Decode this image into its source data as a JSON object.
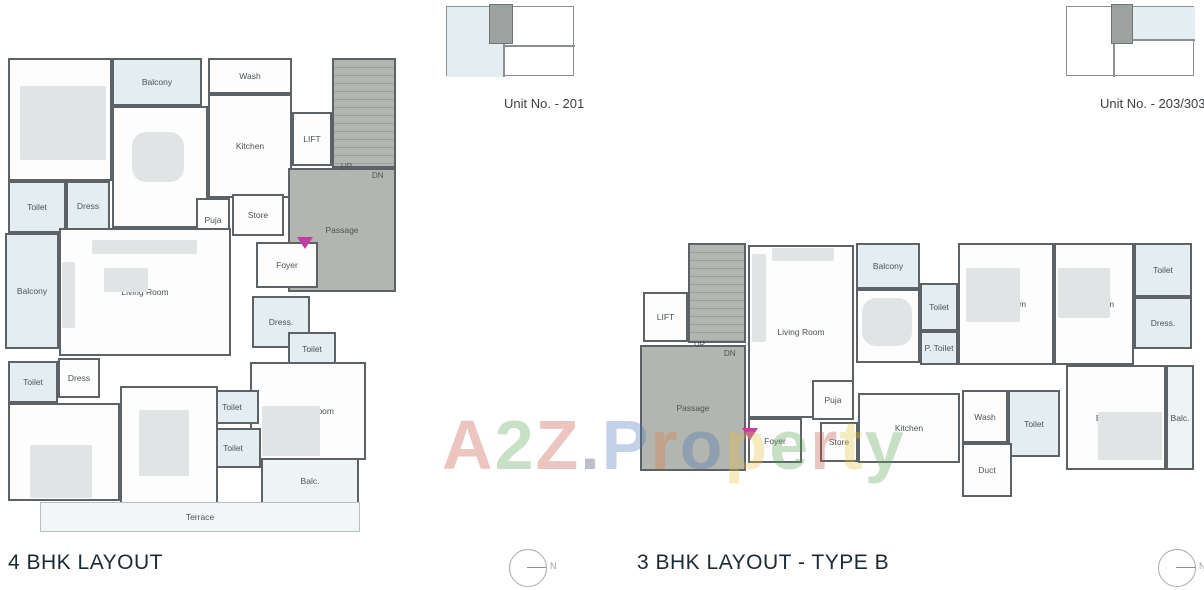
{
  "titles": {
    "left": "4 BHK LAYOUT",
    "right": "3 BHK LAYOUT - TYPE B"
  },
  "unit_labels": {
    "left": "Unit No. - 201",
    "right": "Unit No. - 203/303"
  },
  "compass": {
    "label": "N"
  },
  "colors": {
    "wall": "#5d6266",
    "core": "#b3b5b0",
    "tint": "#e4edef",
    "furn": "#e1e4e5",
    "title": "#1b2a33",
    "label": "#4c5357",
    "door_marker": "#bf3fa3"
  },
  "watermark": {
    "text": "A2Z.Property",
    "opacity": 0.32,
    "letters": [
      {
        "ch": "A",
        "color": "#c64a3e"
      },
      {
        "ch": "2",
        "color": "#58a14e"
      },
      {
        "ch": "Z",
        "color": "#c64a3e"
      },
      {
        "ch": ".",
        "color": "#2e3f5c"
      },
      {
        "ch": "P",
        "color": "#4472b8"
      },
      {
        "ch": "r",
        "color": "#e07b39"
      },
      {
        "ch": "o",
        "color": "#4472b8"
      },
      {
        "ch": "p",
        "color": "#e8c441"
      },
      {
        "ch": "e",
        "color": "#58a14e"
      },
      {
        "ch": "r",
        "color": "#c64a3e"
      },
      {
        "ch": "t",
        "color": "#e8c441"
      },
      {
        "ch": "y",
        "color": "#58a14e"
      }
    ]
  },
  "plans": {
    "left": {
      "rooms": [
        {
          "label": "Bed Room",
          "kind": "white",
          "x": 8,
          "y": 58,
          "w": 104,
          "h": 123
        },
        {
          "label": "Balcony",
          "kind": "tint",
          "x": 112,
          "y": 58,
          "w": 90,
          "h": 48
        },
        {
          "label": "Dining",
          "kind": "white",
          "x": 112,
          "y": 106,
          "w": 96,
          "h": 122
        },
        {
          "label": "Wash",
          "kind": "white",
          "x": 208,
          "y": 58,
          "w": 84,
          "h": 36
        },
        {
          "label": "Kitchen",
          "kind": "white",
          "x": 208,
          "y": 94,
          "w": 84,
          "h": 104
        },
        {
          "label": "LIFT",
          "kind": "white",
          "x": 292,
          "y": 112,
          "w": 40,
          "h": 54
        },
        {
          "label": "",
          "kind": "stairs",
          "x": 332,
          "y": 58,
          "w": 64,
          "h": 110
        },
        {
          "label": "Passage",
          "kind": "core",
          "x": 288,
          "y": 168,
          "w": 108,
          "h": 124
        },
        {
          "label": "Toilet",
          "kind": "tint",
          "x": 8,
          "y": 181,
          "w": 58,
          "h": 52
        },
        {
          "label": "Dress",
          "kind": "tint",
          "x": 66,
          "y": 181,
          "w": 44,
          "h": 50
        },
        {
          "label": "Puja",
          "kind": "white",
          "x": 196,
          "y": 198,
          "w": 34,
          "h": 44
        },
        {
          "label": "Store",
          "kind": "white",
          "x": 232,
          "y": 194,
          "w": 52,
          "h": 42
        },
        {
          "label": "Foyer",
          "kind": "white",
          "x": 256,
          "y": 242,
          "w": 62,
          "h": 46
        },
        {
          "label": "Balcony",
          "kind": "tint",
          "x": 5,
          "y": 233,
          "w": 54,
          "h": 116
        },
        {
          "label": "Living Room",
          "kind": "white",
          "x": 59,
          "y": 228,
          "w": 172,
          "h": 128
        },
        {
          "label": "Dress.",
          "kind": "tint",
          "x": 252,
          "y": 296,
          "w": 58,
          "h": 52
        },
        {
          "label": "Toilet",
          "kind": "tint",
          "x": 288,
          "y": 332,
          "w": 48,
          "h": 34
        },
        {
          "label": "Toilet",
          "kind": "tint",
          "x": 8,
          "y": 361,
          "w": 50,
          "h": 42
        },
        {
          "label": "Dress",
          "kind": "white",
          "x": 58,
          "y": 358,
          "w": 42,
          "h": 40
        },
        {
          "label": "M. Bed Room",
          "kind": "white",
          "x": 250,
          "y": 362,
          "w": 116,
          "h": 98
        },
        {
          "label": "Bed Room",
          "kind": "white",
          "x": 8,
          "y": 403,
          "w": 112,
          "h": 98
        },
        {
          "label": "Toilet",
          "kind": "tint",
          "x": 205,
          "y": 390,
          "w": 54,
          "h": 34
        },
        {
          "label": "Toilet",
          "kind": "tint",
          "x": 205,
          "y": 428,
          "w": 56,
          "h": 40
        },
        {
          "label": "Bed Room",
          "kind": "white",
          "x": 120,
          "y": 386,
          "w": 98,
          "h": 118
        },
        {
          "label": "Balc.",
          "kind": "tint2",
          "x": 261,
          "y": 458,
          "w": 98,
          "h": 46
        },
        {
          "label": "Terrace",
          "kind": "terrace",
          "x": 40,
          "y": 502,
          "w": 320,
          "h": 30
        }
      ],
      "furniture": [
        {
          "x": 20,
          "y": 86,
          "w": 86,
          "h": 74,
          "r": 2
        },
        {
          "x": 132,
          "y": 132,
          "w": 52,
          "h": 50,
          "r": 14
        },
        {
          "x": 92,
          "y": 240,
          "w": 105,
          "h": 14,
          "r": 2
        },
        {
          "x": 62,
          "y": 262,
          "w": 13,
          "h": 66,
          "r": 2
        },
        {
          "x": 104,
          "y": 268,
          "w": 44,
          "h": 24,
          "r": 2
        },
        {
          "x": 30,
          "y": 445,
          "w": 62,
          "h": 53,
          "r": 2
        },
        {
          "x": 139,
          "y": 410,
          "w": 50,
          "h": 66,
          "r": 2
        },
        {
          "x": 262,
          "y": 406,
          "w": 58,
          "h": 50,
          "r": 2
        }
      ],
      "texts": [
        {
          "t": "UP",
          "x": 341,
          "y": 162
        },
        {
          "t": "DN",
          "x": 372,
          "y": 171
        }
      ],
      "door_marker": {
        "x": 297,
        "y": 237
      }
    },
    "right": {
      "rooms": [
        {
          "label": "LIFT",
          "kind": "white",
          "x": 643,
          "y": 292,
          "w": 45,
          "h": 50
        },
        {
          "label": "",
          "kind": "stairs",
          "x": 688,
          "y": 243,
          "w": 58,
          "h": 100
        },
        {
          "label": "Passage",
          "kind": "core",
          "x": 640,
          "y": 345,
          "w": 106,
          "h": 126
        },
        {
          "label": "Living Room",
          "kind": "white",
          "x": 748,
          "y": 245,
          "w": 106,
          "h": 173
        },
        {
          "label": "Balcony",
          "kind": "tint",
          "x": 856,
          "y": 243,
          "w": 64,
          "h": 46
        },
        {
          "label": "Dining",
          "kind": "white",
          "x": 856,
          "y": 289,
          "w": 64,
          "h": 74
        },
        {
          "label": "Toilet",
          "kind": "tint",
          "x": 920,
          "y": 283,
          "w": 38,
          "h": 48
        },
        {
          "label": "P. Toilet",
          "kind": "tint",
          "x": 920,
          "y": 331,
          "w": 38,
          "h": 34
        },
        {
          "label": "Bed Room",
          "kind": "white",
          "x": 958,
          "y": 243,
          "w": 96,
          "h": 122
        },
        {
          "label": "Bed Room",
          "kind": "white",
          "x": 1054,
          "y": 243,
          "w": 80,
          "h": 122
        },
        {
          "label": "Toilet",
          "kind": "tint",
          "x": 1134,
          "y": 243,
          "w": 58,
          "h": 54
        },
        {
          "label": "Dress.",
          "kind": "tint",
          "x": 1134,
          "y": 297,
          "w": 58,
          "h": 52
        },
        {
          "label": "Foyer",
          "kind": "white",
          "x": 748,
          "y": 418,
          "w": 54,
          "h": 45
        },
        {
          "label": "Puja",
          "kind": "white",
          "x": 812,
          "y": 380,
          "w": 42,
          "h": 40
        },
        {
          "label": "Store",
          "kind": "white",
          "x": 820,
          "y": 422,
          "w": 38,
          "h": 40
        },
        {
          "label": "Kitchen",
          "kind": "white",
          "x": 858,
          "y": 393,
          "w": 102,
          "h": 70
        },
        {
          "label": "Wash",
          "kind": "white",
          "x": 962,
          "y": 390,
          "w": 46,
          "h": 53
        },
        {
          "label": "Toilet",
          "kind": "tint",
          "x": 1008,
          "y": 390,
          "w": 52,
          "h": 67
        },
        {
          "label": "Duct",
          "kind": "white",
          "x": 962,
          "y": 443,
          "w": 50,
          "h": 54
        },
        {
          "label": "Bed Room",
          "kind": "white",
          "x": 1066,
          "y": 365,
          "w": 100,
          "h": 105
        },
        {
          "label": "Balc.",
          "kind": "tint2",
          "x": 1166,
          "y": 365,
          "w": 28,
          "h": 105
        }
      ],
      "furniture": [
        {
          "x": 966,
          "y": 268,
          "w": 54,
          "h": 54,
          "r": 2
        },
        {
          "x": 1058,
          "y": 268,
          "w": 52,
          "h": 50,
          "r": 2
        },
        {
          "x": 1098,
          "y": 412,
          "w": 64,
          "h": 48,
          "r": 2
        },
        {
          "x": 862,
          "y": 298,
          "w": 50,
          "h": 48,
          "r": 14
        },
        {
          "x": 752,
          "y": 254,
          "w": 14,
          "h": 88,
          "r": 2
        },
        {
          "x": 772,
          "y": 248,
          "w": 62,
          "h": 13,
          "r": 2
        }
      ],
      "texts": [
        {
          "t": "UP",
          "x": 694,
          "y": 340
        },
        {
          "t": "DN",
          "x": 724,
          "y": 349
        }
      ],
      "door_marker": {
        "x": 742,
        "y": 428
      }
    }
  }
}
